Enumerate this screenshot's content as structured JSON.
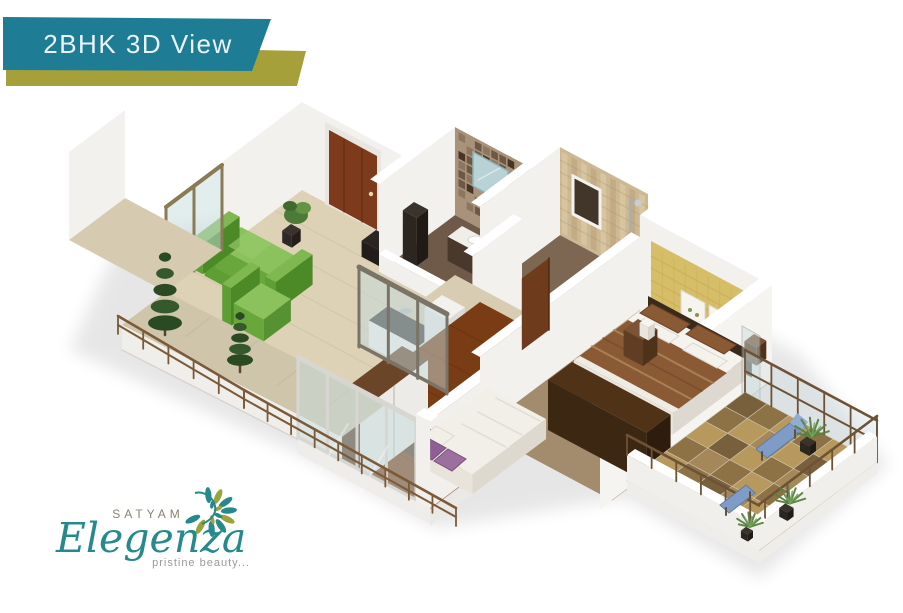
{
  "banner": {
    "title": "2BHK 3D View"
  },
  "logo": {
    "brand_top": "SATYAM",
    "brand_name": "Elegenza",
    "tagline": "pristine beauty..."
  },
  "palette": {
    "banner_teal": "#1e7d95",
    "banner_olive": "#a6a03a",
    "logo_teal": "#26898b",
    "logo_olive": "#9aa33c",
    "logo_brand_gray": "#8b8070",
    "tagline_gray": "#9a9a9a"
  },
  "floorplan": {
    "view": "3d-isometric-render",
    "unit_type": "2BHK",
    "rooms": [
      "living-room",
      "balcony",
      "kitchen",
      "bathroom-1",
      "bathroom-2",
      "master-bedroom",
      "bedroom-2",
      "terrace"
    ],
    "furniture": [
      "entrance-door",
      "tv-unit",
      "green-sofa-set",
      "potted-plants",
      "kitchen-counter",
      "vanity-mirror",
      "wash-basin",
      "toilet",
      "shower",
      "double-bed",
      "bedside-tables",
      "wall-frames",
      "storage-chest",
      "wardrobe",
      "single-bed",
      "glass-windows",
      "lounge-chairs",
      "terrace-plants",
      "railings"
    ],
    "colors": {
      "wall": "#f3f1ee",
      "wallTop": "#ffffff",
      "woodLight": "#ddd1b6",
      "woodDark": "#7a3c14",
      "balconyTile": "#d6cbb0",
      "apron": "#cfc5ab",
      "terraceA": "#b7995d",
      "terraceB": "#8d7245",
      "terraceC": "#79603c",
      "bath1Floor": "#6f5a49",
      "bath1Wall": "#a8927a",
      "bath2Floor": "#7d6753",
      "bath2Wall": "#cdb894",
      "gold": "#d6bd68",
      "sofa": "#5f9e35",
      "blanket": "#8a5a35",
      "purple": "#9b6f9e",
      "lounger": "#7f9cc9",
      "door": "#7e3b1c",
      "glass": "#c6dbde",
      "frameOlive": "#8a7a55",
      "railing": "#7a5a38",
      "railing2": "#6e5236",
      "masterFloor": "#a38b6d",
      "chest": "#3c2712",
      "wardrobe": "#5a3a22"
    }
  }
}
